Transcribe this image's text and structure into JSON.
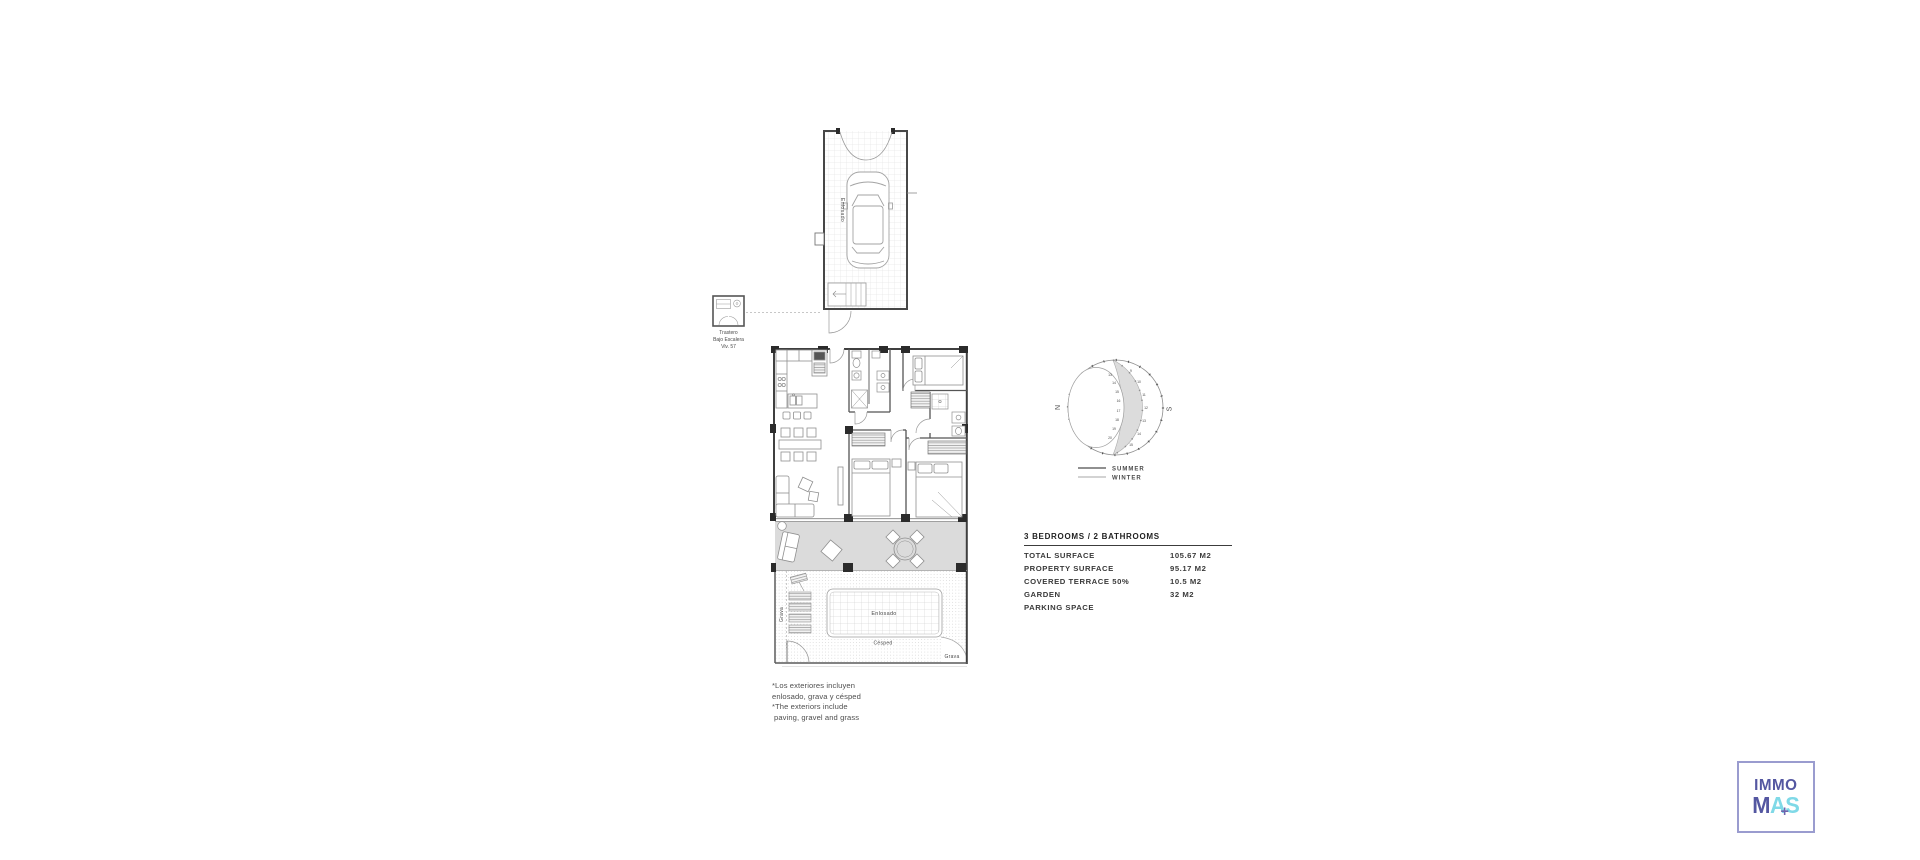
{
  "canvas": {
    "background": "#ffffff"
  },
  "garage_plan": {
    "floor_label": "Enlosado"
  },
  "storage_room": {
    "lines": [
      "Trastero",
      "Bajo Escalera",
      "Viv. 57"
    ]
  },
  "garden": {
    "gravel_left_label": "Grava",
    "paved_label": "Enlosado",
    "grass_label": "Césped",
    "gravel_bottom_label": "Grava"
  },
  "sun_diagram": {
    "north_label": "N",
    "south_label": "S",
    "summer_hours": [
      "13",
      "14",
      "15",
      "16",
      "17",
      "18",
      "19",
      "20"
    ],
    "winter_hours": [
      "9",
      "10",
      "11",
      "12",
      "13",
      "14",
      "15"
    ],
    "legend": {
      "summer": "SUMMER",
      "winter": "WINTER"
    },
    "colors": {
      "shade": "#dcdcdc"
    }
  },
  "specifications": {
    "title": "3 BEDROOMS / 2 BATHROOMS",
    "rows": [
      {
        "label": "TOTAL SURFACE",
        "value": "105.67 M2"
      },
      {
        "label": "PROPERTY SURFACE",
        "value": "95.17 M2"
      },
      {
        "label": "COVERED TERRACE 50%",
        "value": "10.5 M2"
      },
      {
        "label": "GARDEN",
        "value": "32 M2"
      },
      {
        "label": "PARKING SPACE",
        "value": ""
      }
    ]
  },
  "exterior_notes": {
    "lines": [
      "*Los exteriores incluyen",
      "enlosado, grava y césped",
      "*The exteriors include",
      "paving, gravel and grass"
    ]
  },
  "logo": {
    "top_text": "IMMO",
    "m": "M",
    "a": "A",
    "plus": "+",
    "s": "S",
    "colors": {
      "purple": "#5457a1",
      "cyan": "#7fd9e7",
      "plus_purple": "#6f64ad",
      "border": "#9a9ccf"
    }
  }
}
